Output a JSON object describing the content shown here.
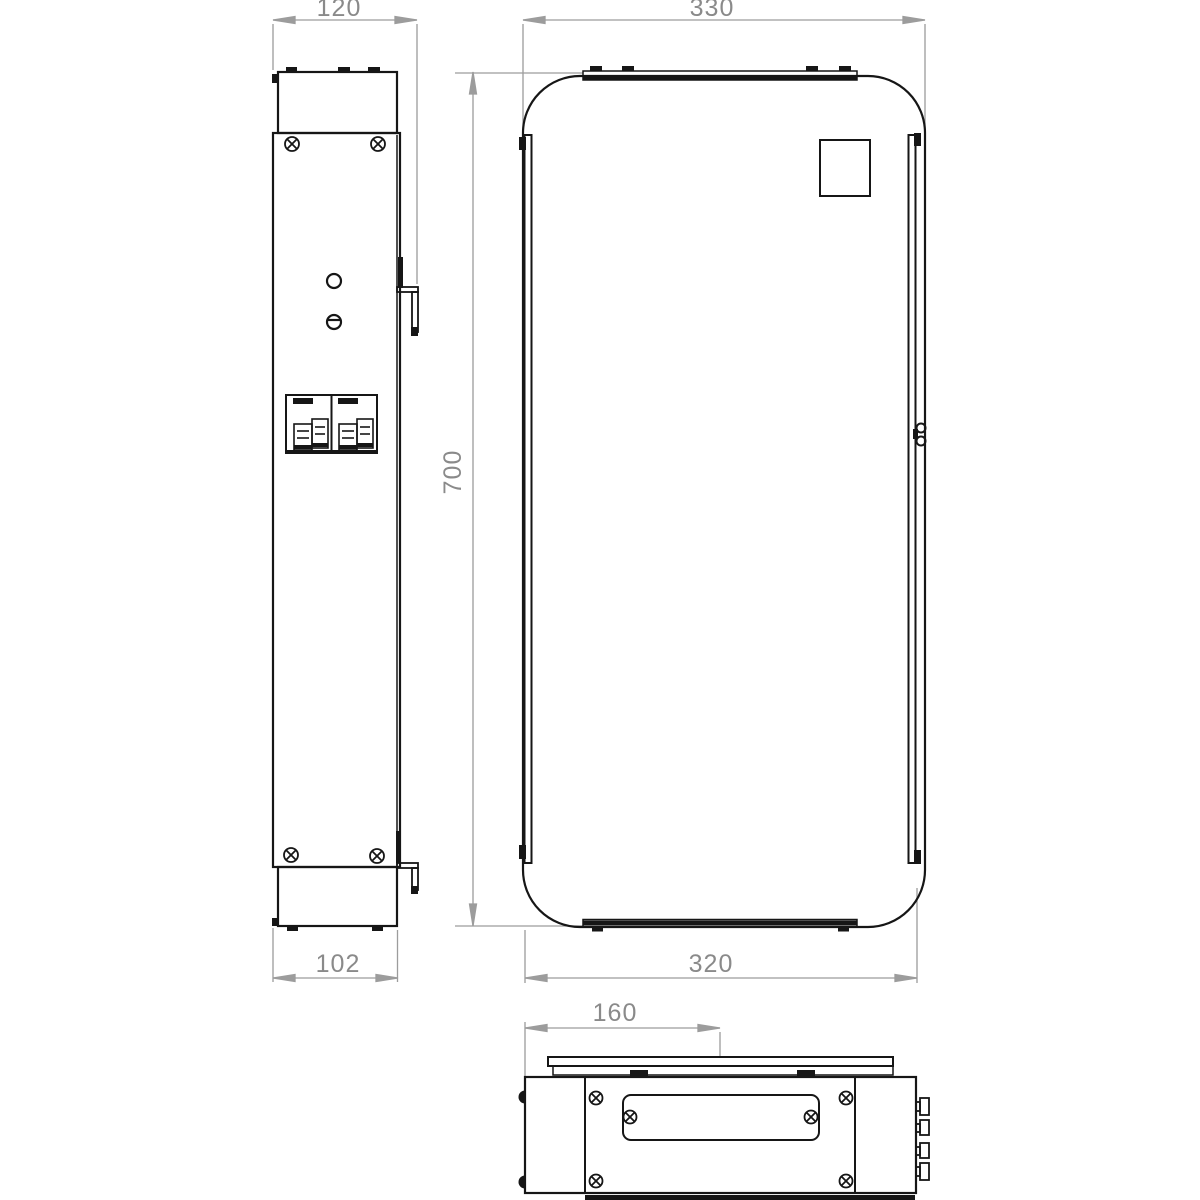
{
  "dimensions": {
    "side_width_mm": "120",
    "front_width_mm": "330",
    "height_mm": "700",
    "depth_mm": "102",
    "front_width_lower_mm": "320",
    "center_offset_mm": "160"
  },
  "colors": {
    "background": "#ffffff",
    "outline": "#161616",
    "dimension_line": "#9c9c9c",
    "dimension_text": "#8a8a8a"
  }
}
